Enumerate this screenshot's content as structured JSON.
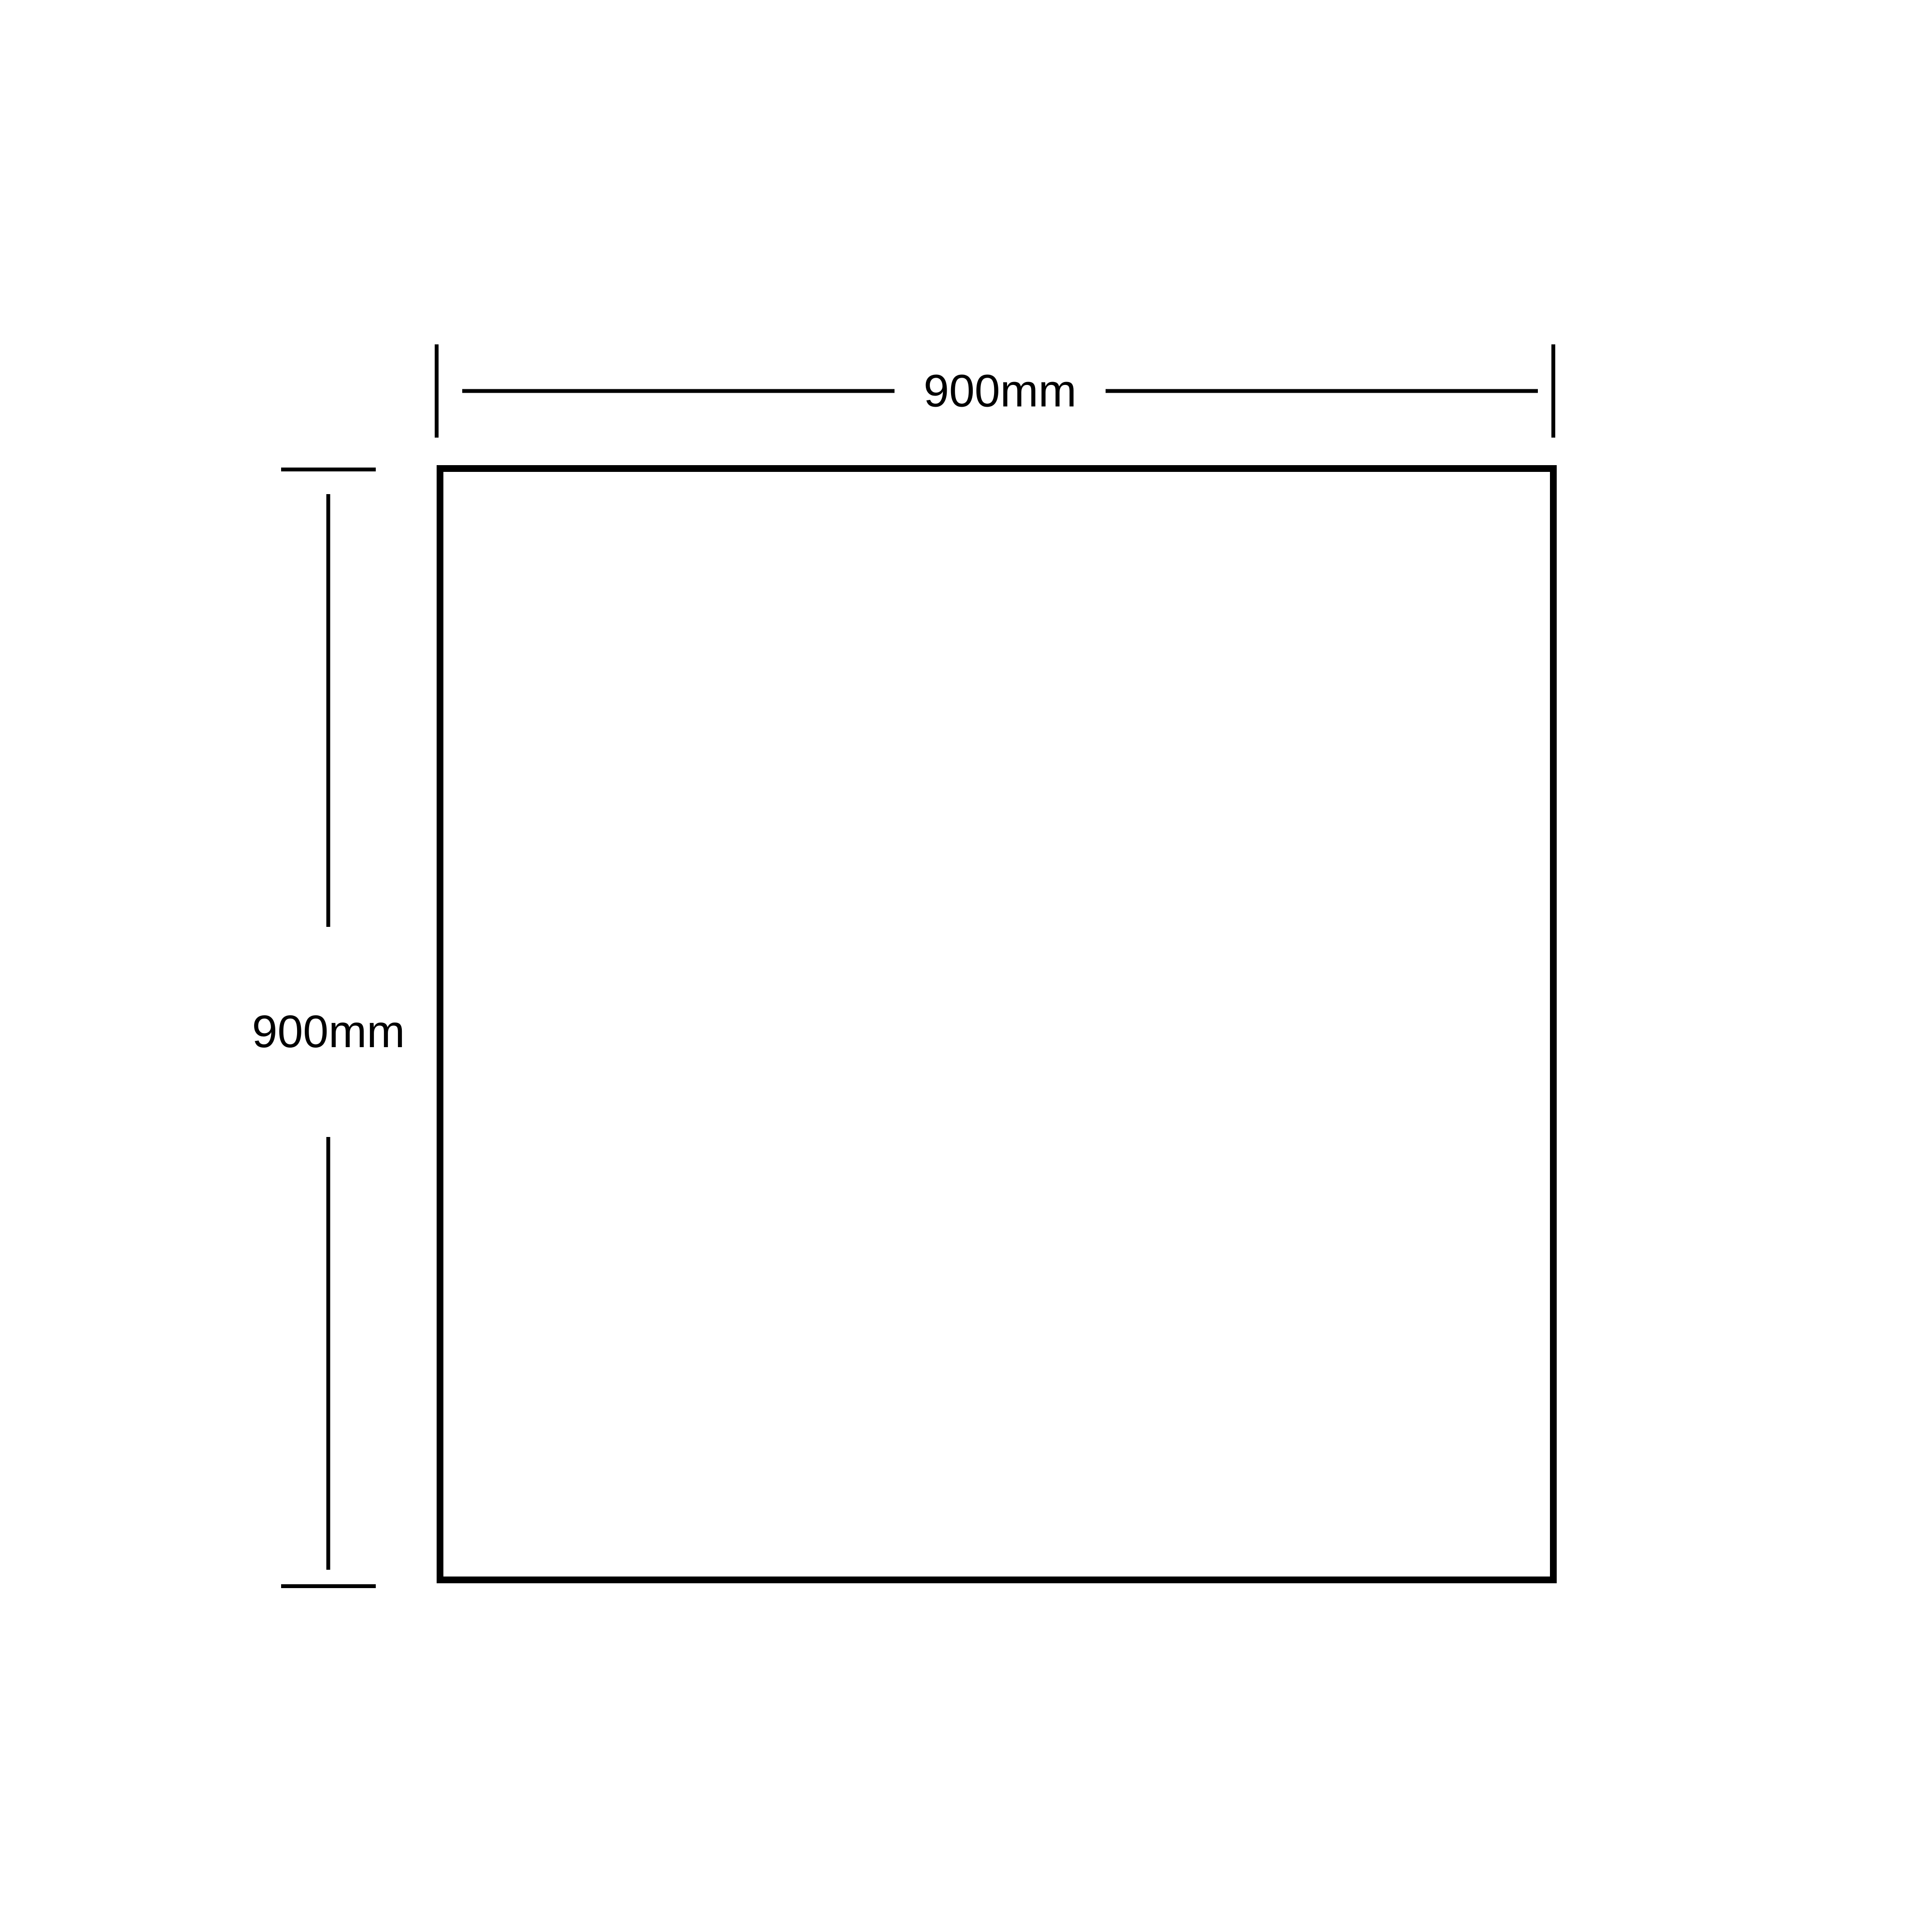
{
  "page": {
    "background": "#ffffff"
  },
  "diagram": {
    "shape": "square-outline",
    "line_color": "#000000",
    "dimensions": {
      "width": {
        "label": "900mm"
      },
      "height": {
        "label": "900mm"
      }
    }
  }
}
